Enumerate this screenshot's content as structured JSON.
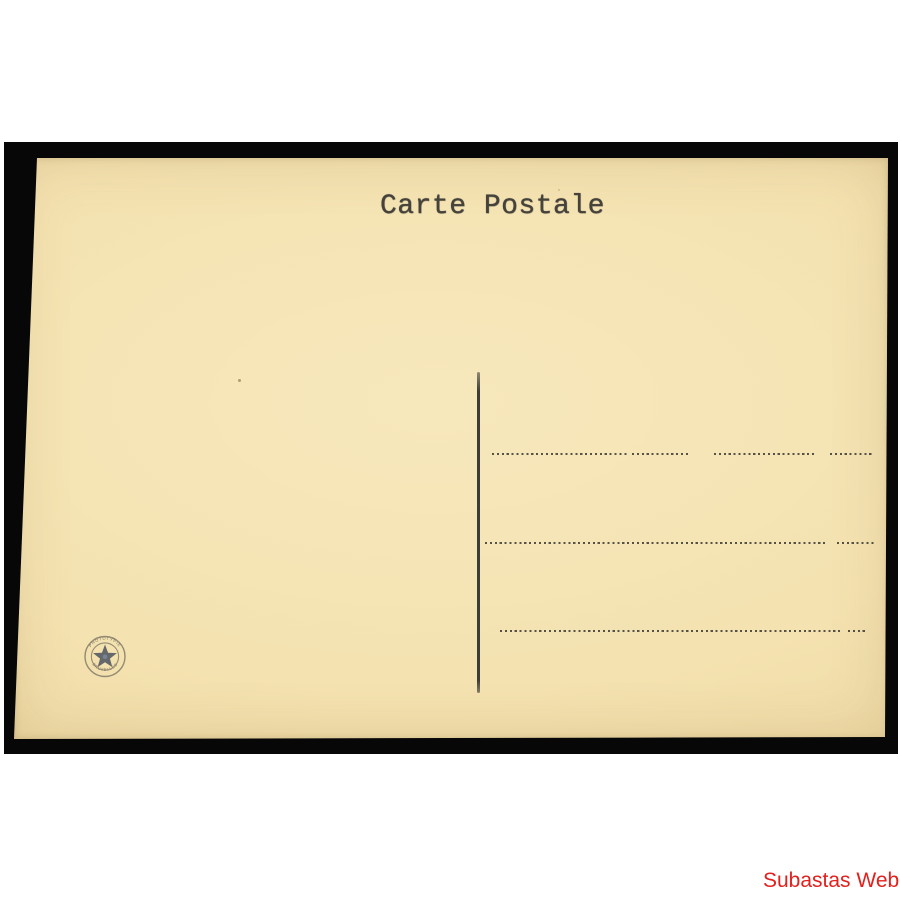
{
  "listing": {
    "watermark_text": "Subastas Web",
    "watermark_color": "#e3201c",
    "background_color": "#ffffff",
    "mat_color": "#070707"
  },
  "postcard": {
    "title": "Carte Postale",
    "paper_color": "#f4e2b0",
    "ink_color": "#403d36",
    "address_line_count": 3,
    "stamp": {
      "icon": "star-in-double-circle",
      "ink_color": "#3e4859",
      "text_top": "PHOTOTYPIE",
      "text_bottom": "BRUXELLES"
    }
  }
}
